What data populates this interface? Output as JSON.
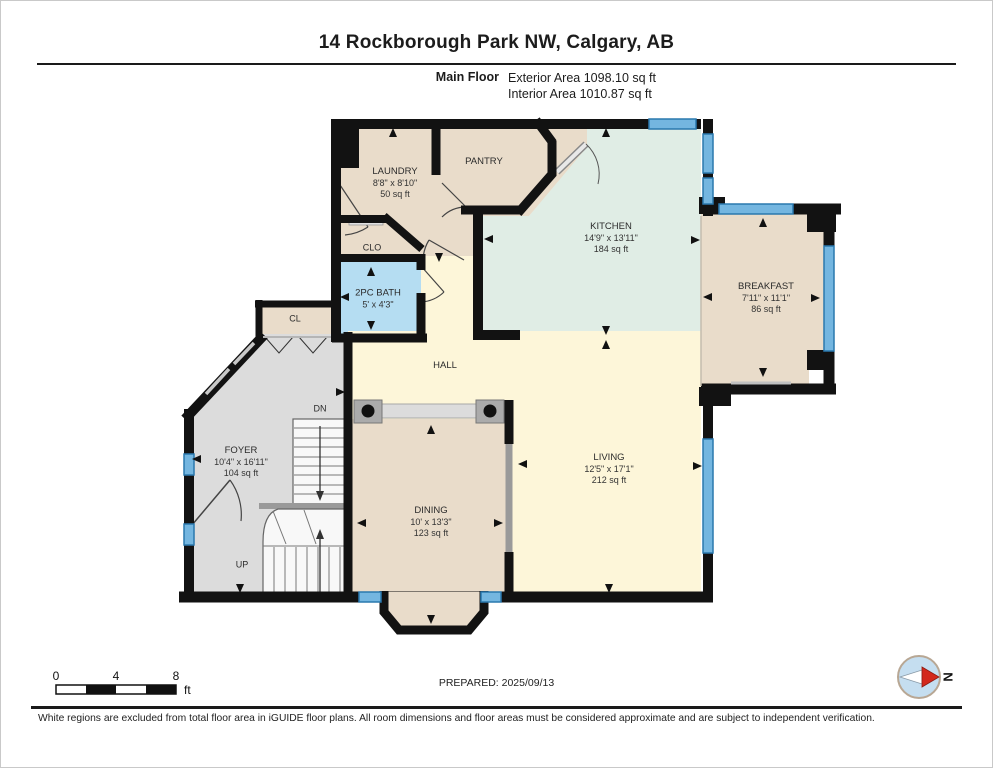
{
  "header": {
    "title": "14 Rockborough Park NW, Calgary, AB",
    "floor_label": "Main Floor",
    "exterior_area": "Exterior Area 1098.10 sq ft",
    "interior_area": "Interior Area 1010.87 sq ft"
  },
  "rooms": {
    "laundry": {
      "name": "LAUNDRY",
      "dims": "8'8\" x 8'10\"",
      "area": "50 sq ft"
    },
    "pantry": {
      "name": "PANTRY"
    },
    "kitchen": {
      "name": "KITCHEN",
      "dims": "14'9\" x 13'11\"",
      "area": "184 sq ft"
    },
    "breakfast": {
      "name": "BREAKFAST",
      "dims": "7'11\" x 11'1\"",
      "area": "86 sq ft"
    },
    "clo": {
      "name": "CLO"
    },
    "bath": {
      "name": "2PC BATH",
      "dims": "5' x 4'3\""
    },
    "cl": {
      "name": "CL"
    },
    "hall": {
      "name": "HALL"
    },
    "foyer": {
      "name": "FOYER",
      "dims": "10'4\" x 16'11\"",
      "area": "104 sq ft"
    },
    "dining": {
      "name": "DINING",
      "dims": "10' x 13'3\"",
      "area": "123 sq ft"
    },
    "living": {
      "name": "LIVING",
      "dims": "12'5\" x 17'1\"",
      "area": "212 sq ft"
    },
    "stairs_down": {
      "name": "DN"
    },
    "stairs_up": {
      "name": "UP"
    }
  },
  "footer": {
    "scale": {
      "tick0": "0",
      "tick4": "4",
      "tick8": "8",
      "unit": "ft"
    },
    "prepared": "PREPARED: 2025/09/13",
    "compass_label": "N",
    "disclaimer": "White regions are excluded from total floor area in iGUIDE floor plans. All room dimensions and floor areas must be considered approximate and are subject to independent verification."
  },
  "colors": {
    "room_beige": "#e9dcca",
    "kitchen_green": "#e0ede5",
    "hall_yellow": "#fdf6d9",
    "bath_blue": "#b5ddf2",
    "foyer_gray": "#dcdcdc",
    "window_blue": "#74b6e0",
    "wall_black": "#121212",
    "compass_red": "#d3281c"
  }
}
